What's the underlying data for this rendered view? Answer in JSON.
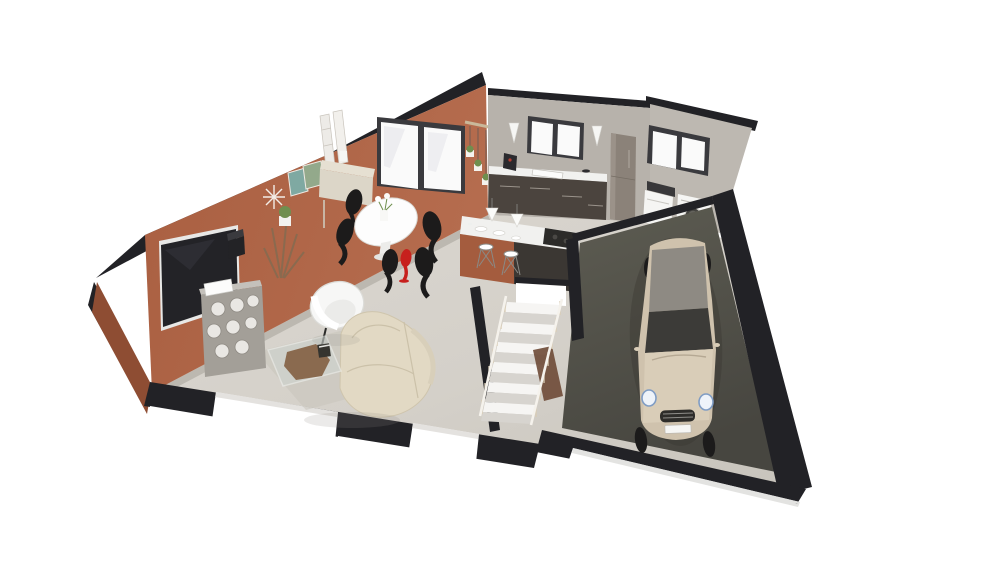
{
  "scene": {
    "type": "3d-floor-plan-render",
    "alt": "3D isometric floor plan rendering of a single-storey home with living-dining room, kitchen, laundry corner, staircase and garage with a parked car"
  },
  "palette": {
    "bg": "#ffffff",
    "wall-cap": "#222226",
    "wall-terracotta": "#ad6547",
    "wall-terracotta-dark": "#8e4d33",
    "wall-kitchen": "#b7b2ab",
    "wall-laundry": "#bdb8b1",
    "floor-main": "#d6d2cb",
    "floor-garage": "#56554b",
    "wall-white": "#ffffff",
    "window-frame": "#3a3a3e",
    "window-glass": "#fafafa",
    "counter-top": "#f1f1ef",
    "cabinet-front": "#4b443e",
    "fridge": "#8b8279",
    "island-front": "#a45c3e",
    "island-base": "#3b3733",
    "cooktop": "#2c2b29",
    "appliance": "#f5f5f3",
    "appliance-dark": "#39383a",
    "stair-tread": "#f6f5f3",
    "stair-riser": "#d7d4cf",
    "stair-brown": "#6e4a36",
    "rail-wood": "#d9ccb4",
    "rail-white": "#f5f2ec",
    "car-body": "#cfc2ad",
    "car-body-light": "#d9cdb8",
    "car-roof": "#8e8a83",
    "car-glass": "#3c3b38",
    "sofa": "#e2d9c4",
    "chair-white": "#f7f7f6",
    "chair-black": "#1c1b1b",
    "accent-red": "#c7201d",
    "table-white": "#fdfdfd",
    "wood": "#8a6a4f",
    "plant": "#6f8f4f",
    "console": "#e6e0d2",
    "shelf": "#a39f98",
    "shelf-cell": "#e9e7e3",
    "tv-screen": "#232327",
    "rug": "#c9c4bc",
    "glass-table": "#ced4d0"
  },
  "objects": [
    "terracotta-living-wall",
    "french-doors",
    "wall-clock",
    "wall-pictures",
    "ladder-mirror",
    "tv",
    "speaker",
    "honeycomb-shelf",
    "driftwood-plant",
    "console-table",
    "dining-table",
    "dining-chairs",
    "red-accent-chair",
    "armchair",
    "sofa",
    "coffee-table",
    "rug",
    "kitchen-wall",
    "kitchen-window",
    "wall-sconces",
    "kitchen-counter",
    "sink",
    "coffee-machine",
    "fridge",
    "kitchen-island",
    "cooktop",
    "bar-stools",
    "pendant-lamps",
    "tableware",
    "laundry-wall",
    "laundry-window",
    "washing-machine",
    "dryer",
    "staircase",
    "stair-railing",
    "garage",
    "car",
    "front-wall-cut",
    "window-sills"
  ]
}
